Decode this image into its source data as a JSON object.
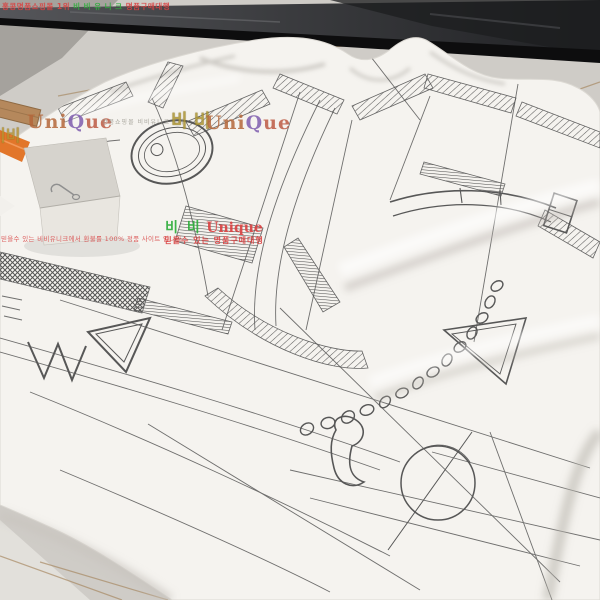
{
  "photo": {
    "subject": "white t-shirt with hand-drawn equestrian harness sketch print, hang tag and orange strap, lying on a grey tiled floor beside a dark mirror base",
    "palette": {
      "floor_tile": "#cfccc7",
      "floor_tile_corner": "#a5a29d",
      "floor_tile_bottom": "#e2e0db",
      "grout": "#a5855d",
      "mirror_glass": "#3f4043",
      "mirror_base": "#0d0d0e",
      "shirt": "#f5f3ef",
      "sketch_ink": "#474747",
      "wood_stick": "#b5885c",
      "strap_orange": "#e2762a",
      "hang_tag": "#ddd9d3",
      "watermark_red": "#d94343",
      "watermark_green": "#2fae3c",
      "watermark_gold": "#b3922f",
      "watermark_tan": "#b4673a",
      "watermark_purple": "#7e5cae"
    },
    "watermarks": {
      "top_banner": {
        "prefix": "홍콩명품쇼핑몰 1위 ",
        "brand": "비 비 유 니 크",
        "suffix": " 명품구매대행"
      },
      "mid_row": {
        "gold_partial": "비비",
        "unique_a": "Uni",
        "unique_b": "Q",
        "unique_c": "ue",
        "faint_text": "명품쇼핑몰 비비유니크 1위",
        "gold_bibi": "비 비"
      },
      "center_stamp": {
        "bibi": "비 비",
        "brand": "Unique",
        "tagline": "믿을수 있는 명품구매대행"
      },
      "side_line": "믿을수 있는 비비유니크에서 환불률 100% 정품 사이트 입니다"
    }
  }
}
